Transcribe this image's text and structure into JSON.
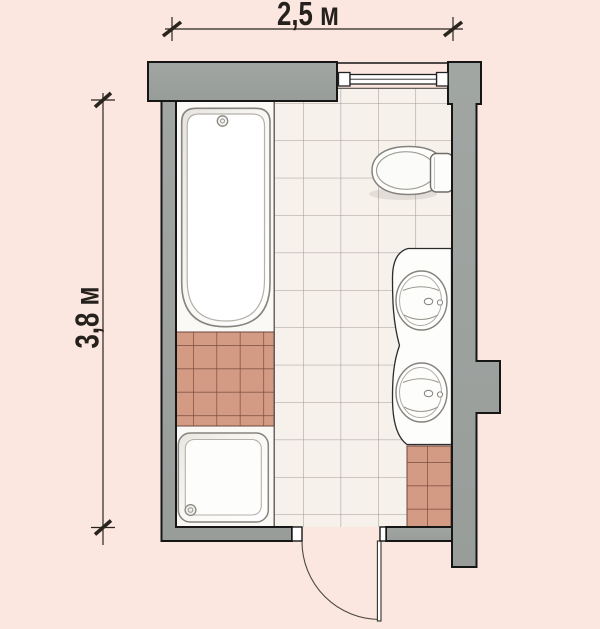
{
  "title": "bathroom-floor-plan",
  "dimensions": {
    "width_label": "2,5 м",
    "height_label": "3,8 м"
  },
  "fixtures": {
    "bathtub": "bathtub",
    "shower_tray": "shower-tray",
    "toilet": "toilet",
    "vanity": "double-vanity-counter",
    "sink_top": "sink",
    "sink_bottom": "sink",
    "door": "swing-door",
    "window": "window"
  },
  "colors": {
    "background": "#fbe7df",
    "wall_fill": "#9da3a0",
    "wall_outline": "#161616",
    "floor_tile": "#f7f1ec",
    "tile_line": "#a39b96",
    "accent_tile": "#d39a84",
    "accent_tile_line": "#7c4c3e",
    "fixture_white": "#ffffff",
    "dimension_ink": "#26211d"
  }
}
